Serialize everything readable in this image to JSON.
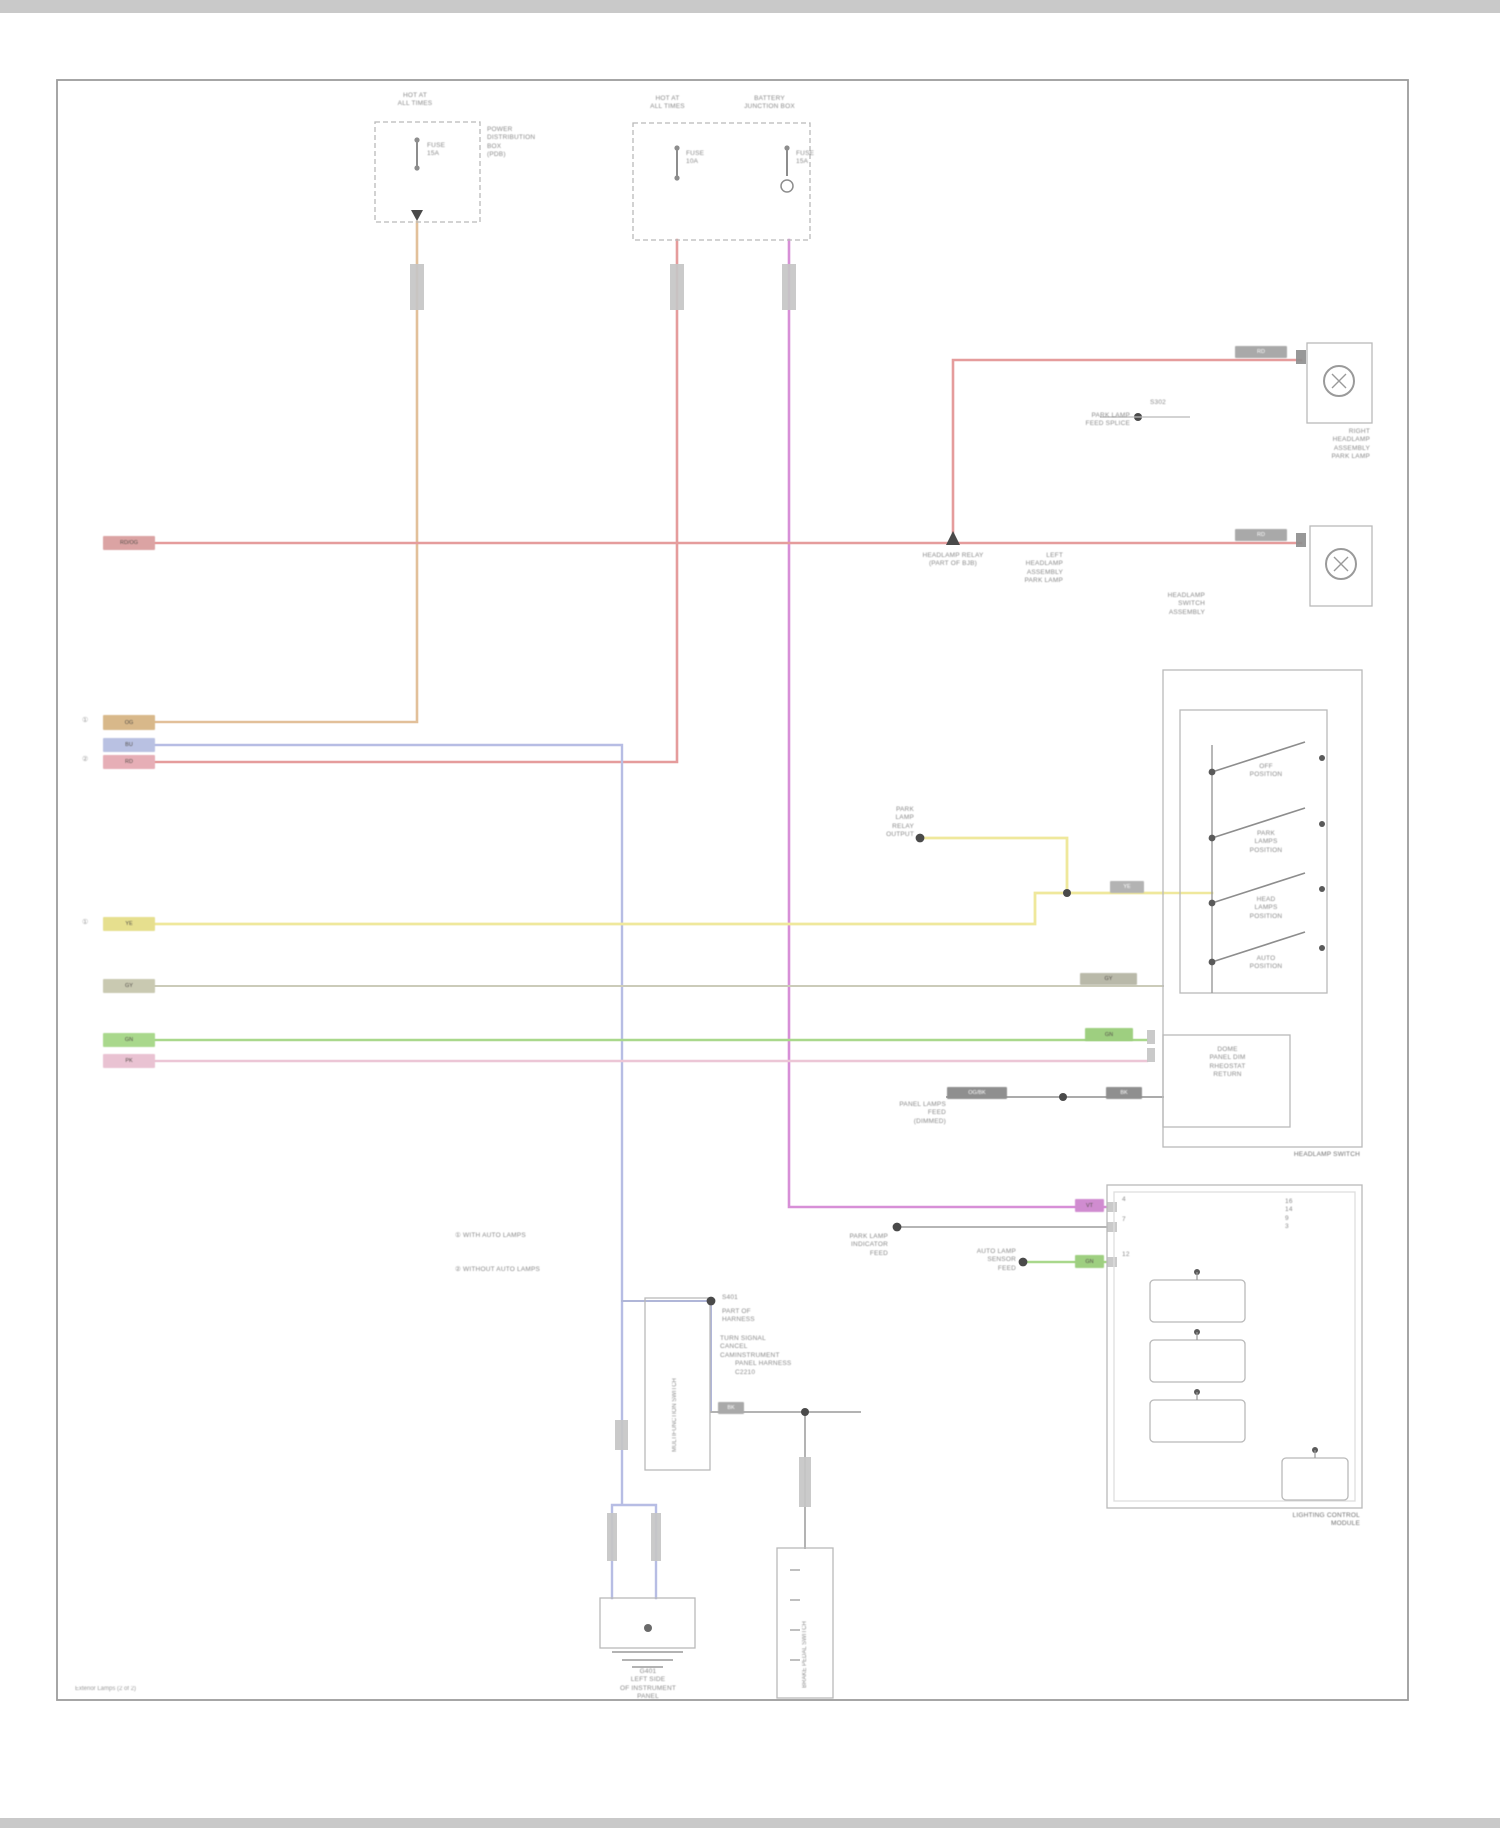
{
  "footer": "Exterior Lamps (2 of 2)",
  "colors": {
    "orange_wire": "#e2c09a",
    "red_wire": "#e59c9c",
    "magenta_wire": "#d78fd7",
    "blue_wire": "#b7bde4",
    "yellow_wire": "#efe89c",
    "green_wire": "#a9d88c",
    "pink_wire": "#ecc6d6",
    "gray_wire": "#b5b5b5",
    "box_line": "#b9b9b9"
  },
  "power_box": {
    "header": "HOT AT\nALL TIMES",
    "name": "POWER\nDISTRIBUTION\nBOX\n(PDB)",
    "fuse": "FUSE\n15A"
  },
  "junction_box": {
    "header_left": "HOT AT\nALL TIMES",
    "header_right": "BATTERY\nJUNCTION BOX",
    "fuse_a": "FUSE\n10A",
    "fuse_b": "FUSE\n15A"
  },
  "relay_callout": "HEADLAMP RELAY\n(PART OF BJB)",
  "splice_callout": {
    "text": "PARK LAMP\nFEED SPLICE",
    "tag": "S302"
  },
  "lamp_right": "RIGHT\nHEADLAMP\nASSEMBLY\nPARK LAMP",
  "lamp_left": "LEFT\nHEADLAMP\nASSEMBLY\nPARK LAMP",
  "headlamp_switch": {
    "header": "HEADLAMP\nSWITCH\nASSEMBLY",
    "label": "HEADLAMP SWITCH",
    "pos1": "OFF\nPOSITION",
    "pos2": "PARK\nLAMPS\nPOSITION",
    "pos3": "HEAD\nLAMPS\nPOSITION",
    "pos4": "AUTO\nPOSITION",
    "sub_rows": "DOME\nPANEL DIM\nRHEOSTAT\nRETURN"
  },
  "module": {
    "label": "LIGHTING CONTROL\nMODULE",
    "pins_right": "16\n14\n9\n3",
    "pin_a": "4",
    "pin_b": "7",
    "pin_c": "12"
  },
  "yellow_callout": "PARK\nLAMP\nRELAY\nOUTPUT",
  "panel_callout": "PANEL LAMPS\nFEED\n(DIMMED)",
  "indicator_callout": "PARK LAMP\nINDICATOR\nFEED",
  "sensor_callout": "AUTO LAMP\nSENSOR\nFEED",
  "splice2": {
    "tag": "S401",
    "text": "PART OF\nHARNESS"
  },
  "harness_callout": "INSTRUMENT\nPANEL HARNESS\nC2210",
  "multifunction": {
    "vertical": "MULTIFUNCTION SWITCH",
    "side": "TURN SIGNAL\nCANCEL\nCAM"
  },
  "pedal_switch": {
    "vertical": "BRAKE PEDAL SWITCH"
  },
  "ground": "G401\nLEFT SIDE\nOF INSTRUMENT\nPANEL",
  "legend": {
    "item1": "① WITH AUTO LAMPS",
    "item2": "② WITHOUT AUTO LAMPS"
  },
  "marks": {
    "m1": "①",
    "m2": "②",
    "m3": "①"
  },
  "wire_labels": {
    "red_main": "RD/OG",
    "orange": "OG",
    "blue": "BU",
    "red2": "RD",
    "yellow": "YE",
    "gray": "GY",
    "green": "GN",
    "pink": "PK",
    "rd_a": "RD",
    "rd_b": "RD",
    "ye_b": "YE",
    "vt": "VT",
    "gn_b": "GN",
    "gy_a": "OG/BK",
    "gy_b": "BK",
    "bk": "BK"
  }
}
